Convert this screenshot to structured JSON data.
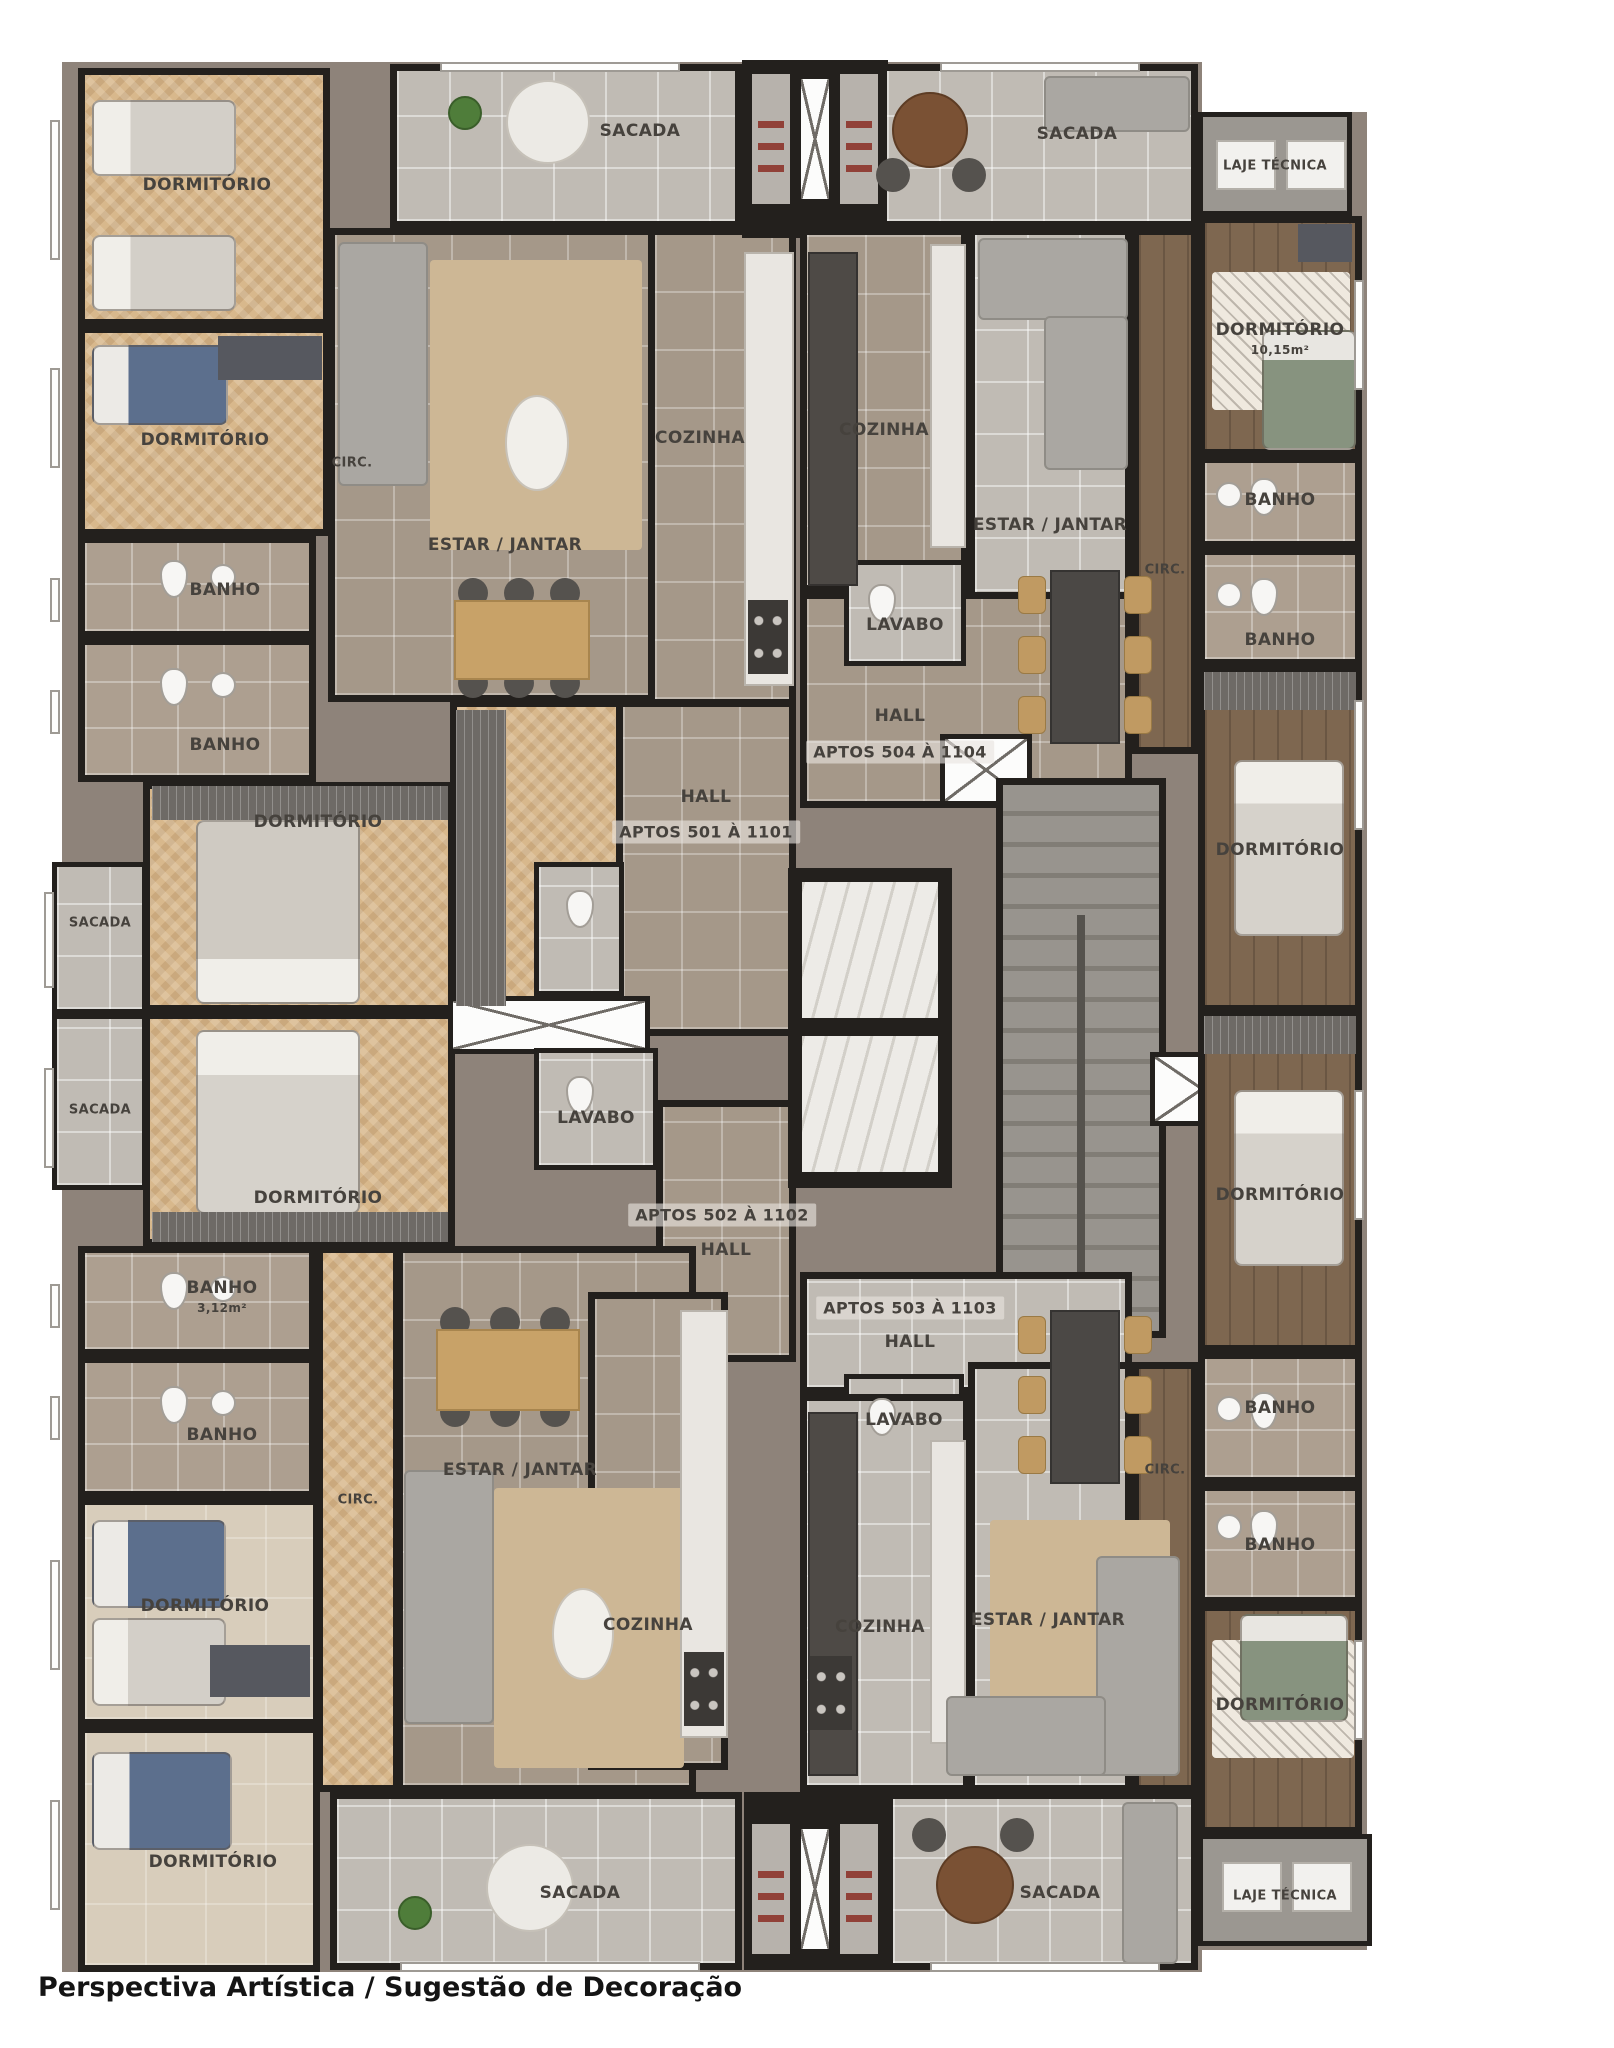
{
  "caption": "Perspectiva Artística / Sugestão de Decoração",
  "room_labels": {
    "dormitorio": "DORMITÓRIO",
    "dormitorio_area": "10,15m²",
    "banho": "BANHO",
    "banho_area": "3,12m²",
    "cozinha": "COZINHA",
    "estar_jantar": "ESTAR / JANTAR",
    "sacada": "SACADA",
    "circ": "CIRC.",
    "lavabo": "LAVABO",
    "hall": "HALL",
    "laje_tecnica": "LAJE TÉCNICA"
  },
  "apartments": {
    "apt_501": "APTOS 501 À 1101",
    "apt_502": "APTOS 502 À 1102",
    "apt_503": "APTOS 503 À 1103",
    "apt_504": "APTOS 504 À 1104"
  },
  "colors": {
    "wall": "#23201d",
    "tile_brown": "#a59889",
    "tile_grey": "#c0bbb4",
    "wood_light": "#d8b88c",
    "wood_dark": "#7e6750",
    "marble": "#edebe7",
    "label_text": "#46423d",
    "background": "#ffffff"
  }
}
